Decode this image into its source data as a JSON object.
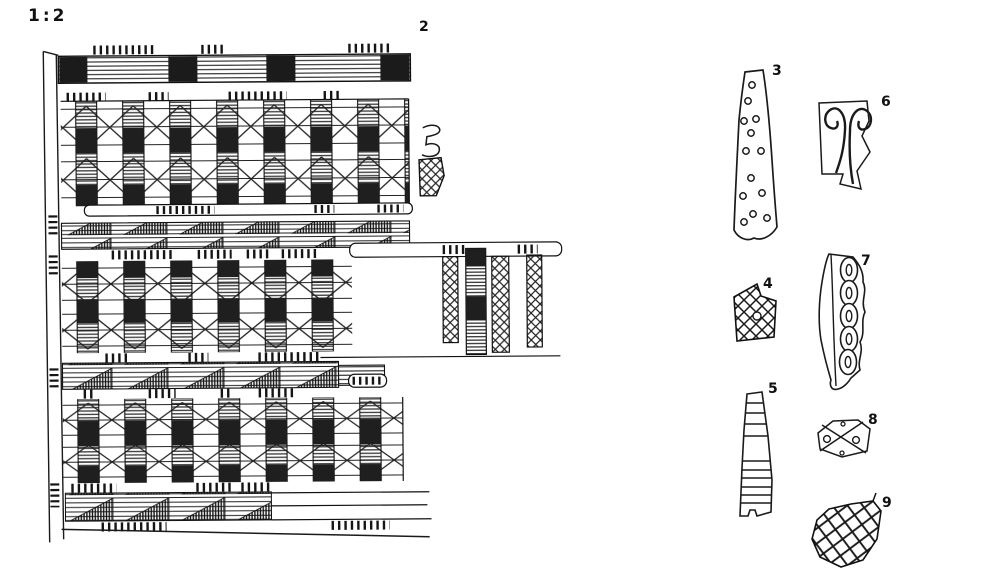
{
  "scale_label": "1:2",
  "colors": {
    "ink": "#1a1a1a",
    "background": "#ffffff"
  },
  "figure": {
    "type": "archaeological-plate-drawing",
    "items": [
      {
        "number": "2",
        "name": "large-ornamented-band-fragment"
      },
      {
        "number": "3",
        "number_hint": "tapering strip with small circles",
        "name": "perforated-strip-fragment"
      },
      {
        "number": "4",
        "number_hint": "crosshatched lattice fragment",
        "name": "lattice-fragment"
      },
      {
        "number": "5",
        "number_hint": "tapering strip with horizontal lines",
        "name": "lined-strip-fragment"
      },
      {
        "number": "6",
        "number_hint": "fragment with double spiral motif",
        "name": "double-spiral-fragment"
      },
      {
        "number": "7",
        "number_hint": "moulding with oval chain",
        "name": "oval-chain-fragment"
      },
      {
        "number": "8",
        "number_hint": "lozenge fragment with X and dots",
        "name": "lozenge-fragment"
      },
      {
        "number": "9",
        "number_hint": "sherd with wide net pattern",
        "name": "net-pattern-sherd"
      }
    ]
  }
}
